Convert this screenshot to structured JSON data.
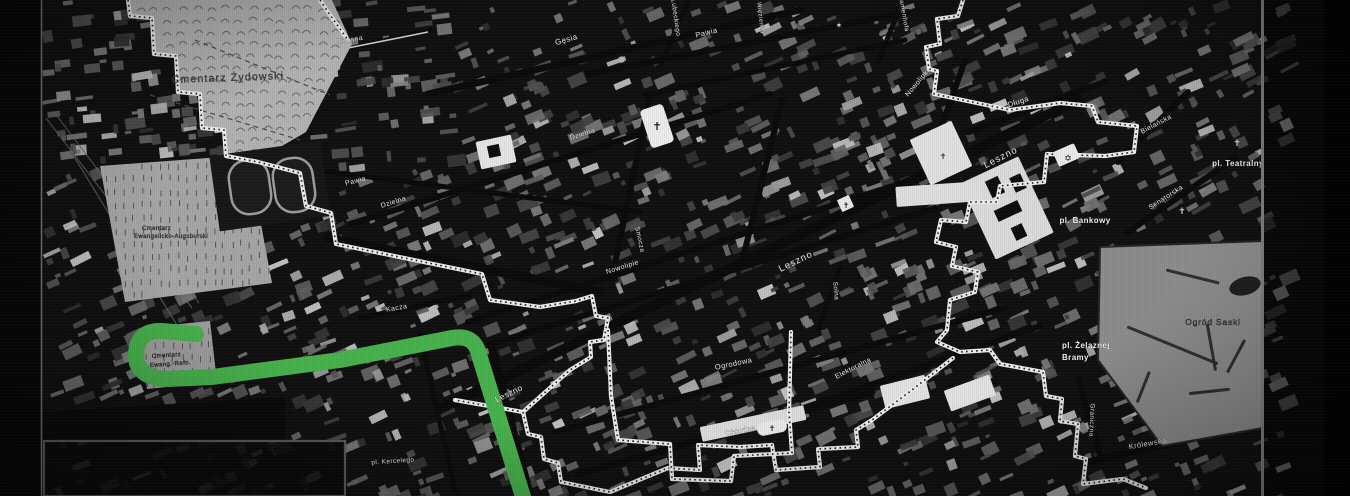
{
  "meta": {
    "width": 1350,
    "height": 496,
    "description": "Stylized dark historical street map of Warsaw with ghetto boundary (white stitched line) and a green walking route"
  },
  "colors": {
    "background": "#101010",
    "street": "#0a0a0a",
    "route_green": "#46b34b",
    "boundary_white": "#ededed",
    "boundary_dot": "#1c1c1c",
    "cemetery_light": "#b3b3b3",
    "park_grey": "#8d8d8d",
    "label_white": "#f2f2f2",
    "label_dark": "#3e3e3e"
  },
  "labels": [
    {
      "text": "Cmentarz Żydowski",
      "x": 228,
      "y": 81,
      "rot": -2,
      "size": 10.5,
      "color": "#4a4a4a",
      "ls": 1.2
    },
    {
      "text": "Cmentarz",
      "x": 142,
      "y": 230,
      "rot": 0,
      "size": 6,
      "color": "#3e3e3e",
      "anchor": "start"
    },
    {
      "text": "Ewangelicko-Augsburski",
      "x": 134,
      "y": 238,
      "rot": 0,
      "size": 6,
      "color": "#3e3e3e",
      "anchor": "start"
    },
    {
      "text": "Cmentarz",
      "x": 152,
      "y": 358,
      "rot": -4,
      "size": 6,
      "color": "#383838",
      "anchor": "start"
    },
    {
      "text": "Ewang.-Refo.",
      "x": 150,
      "y": 367,
      "rot": -4,
      "size": 6,
      "color": "#383838",
      "anchor": "start"
    },
    {
      "text": "Gliniana",
      "x": 349,
      "y": 42,
      "rot": -9,
      "size": 7
    },
    {
      "text": "Gęsia",
      "x": 567,
      "y": 42,
      "rot": -16,
      "size": 8
    },
    {
      "text": "Lubeckiego",
      "x": 674,
      "y": 18,
      "rot": 82,
      "size": 6.5
    },
    {
      "text": "Pawia",
      "x": 707,
      "y": 35,
      "rot": -14,
      "size": 7.5
    },
    {
      "text": "Więzienna",
      "x": 759,
      "y": 18,
      "rot": 84,
      "size": 6
    },
    {
      "text": "Zamenhofa",
      "x": 902,
      "y": 14,
      "rot": 80,
      "size": 6.5
    },
    {
      "text": "Pawia",
      "x": 356,
      "y": 183,
      "rot": -14,
      "size": 7
    },
    {
      "text": "Dzielna",
      "x": 394,
      "y": 204,
      "rot": -17,
      "size": 7
    },
    {
      "text": "Dzielna",
      "x": 583,
      "y": 136,
      "rot": -17,
      "size": 7
    },
    {
      "text": "Smocza",
      "x": 638,
      "y": 240,
      "rot": 78,
      "size": 6.5
    },
    {
      "text": "Nowolipki",
      "x": 919,
      "y": 84,
      "rot": -50,
      "size": 7
    },
    {
      "text": "Nowolipie",
      "x": 623,
      "y": 269,
      "rot": -17,
      "size": 7
    },
    {
      "text": "Leszno",
      "x": 797,
      "y": 264,
      "rot": -26,
      "size": 9.5,
      "ls": 1
    },
    {
      "text": "Leszno",
      "x": 1002,
      "y": 160,
      "rot": -27,
      "size": 9.5,
      "ls": 1
    },
    {
      "text": "Leszno",
      "x": 510,
      "y": 396,
      "rot": -26,
      "size": 8.5
    },
    {
      "text": "Kacza",
      "x": 397,
      "y": 310,
      "rot": -10,
      "size": 7
    },
    {
      "text": "Ogrodowa",
      "x": 734,
      "y": 366,
      "rot": -12,
      "size": 7.5
    },
    {
      "text": "Elektoralna",
      "x": 854,
      "y": 370,
      "rot": -27,
      "size": 7
    },
    {
      "text": "Chłodna",
      "x": 741,
      "y": 433,
      "rot": -11,
      "size": 7.5
    },
    {
      "text": "Solna",
      "x": 834,
      "y": 291,
      "rot": 85,
      "size": 6.5
    },
    {
      "text": "Długa",
      "x": 1019,
      "y": 104,
      "rot": -18,
      "size": 7.5
    },
    {
      "text": "Bielańska",
      "x": 1157,
      "y": 126,
      "rot": -28,
      "size": 7
    },
    {
      "text": "Senatorska",
      "x": 1167,
      "y": 199,
      "rot": -33,
      "size": 7
    },
    {
      "text": "pl. Teatralny",
      "x": 1238,
      "y": 166,
      "rot": 0,
      "size": 8,
      "bold": true
    },
    {
      "text": "pl. Bankowy",
      "x": 1085,
      "y": 223,
      "rot": 0,
      "size": 8,
      "bold": true
    },
    {
      "text": "pl. Żelaznej",
      "x": 1062,
      "y": 348,
      "rot": 0,
      "size": 8,
      "bold": true,
      "anchor": "start"
    },
    {
      "text": "Bramy",
      "x": 1062,
      "y": 360,
      "rot": 0,
      "size": 8,
      "bold": true,
      "anchor": "start"
    },
    {
      "text": "Ogród Saski",
      "x": 1213,
      "y": 325,
      "rot": 0,
      "size": 8.5,
      "color": "#3c3c3c",
      "ls": 0.8
    },
    {
      "text": "Królewska",
      "x": 1148,
      "y": 446,
      "rot": -10,
      "size": 7.5
    },
    {
      "text": "Graniczna",
      "x": 1090,
      "y": 420,
      "rot": 92,
      "size": 6.5
    },
    {
      "text": "pl. Kercelego",
      "x": 393,
      "y": 463,
      "rot": -4,
      "size": 6.5
    }
  ],
  "icons": [
    {
      "name": "church-icon-dzielna",
      "glyph": "✝",
      "x": 657,
      "y": 130,
      "size": 11,
      "fill": "#1d1d1d",
      "bg": {
        "x": 645,
        "y": 106,
        "w": 24,
        "h": 40,
        "rx": 4,
        "rot": -18,
        "fill": "#ededed"
      }
    },
    {
      "name": "church-cross-icon-leszno",
      "glyph": "✝",
      "x": 846,
      "y": 208,
      "size": 8,
      "fill": "#222222",
      "bg": {
        "x": 839,
        "y": 197,
        "w": 13,
        "h": 13,
        "rx": 1,
        "rot": -25,
        "fill": "#e9e9e9"
      }
    },
    {
      "name": "church-cross-icon-west",
      "glyph": "✝",
      "x": 943,
      "y": 159,
      "size": 8,
      "fill": "#2a2a2a"
    },
    {
      "name": "star-of-david-icon",
      "glyph": "✡",
      "x": 1068,
      "y": 161,
      "size": 9,
      "fill": "#1e1e1e",
      "bg": {
        "x": 1055,
        "y": 147,
        "w": 23,
        "h": 16,
        "rx": 2,
        "rot": -24,
        "fill": "#ececec"
      }
    },
    {
      "name": "synagogue-star-icon",
      "glyph": "✶",
      "x": 839,
      "y": 28,
      "size": 8,
      "fill": "#e8e8e8"
    },
    {
      "name": "church-cross-icon-senatorska",
      "glyph": "✝",
      "x": 1182,
      "y": 214,
      "size": 9,
      "fill": "#dedede"
    },
    {
      "name": "church-cross-icon-bielanska",
      "glyph": "✝",
      "x": 1237,
      "y": 146,
      "size": 9,
      "fill": "#dedede"
    },
    {
      "name": "church-icon-chlodna",
      "glyph": "✝",
      "x": 772,
      "y": 431,
      "size": 8,
      "fill": "#1d1d1d",
      "bg": {
        "x": 757,
        "y": 421,
        "w": 30,
        "h": 13,
        "rx": 6,
        "rot": -11,
        "fill": "#e9e9e9"
      }
    }
  ],
  "route": {
    "color": "#46b34b",
    "stroke_width": 16,
    "path": "M196,334 L162,331 C142,330 136,342 136,356 C136,372 150,379 168,379 L212,377 L340,360 L452,338 C470,335 477,343 480,358 L524,500"
  },
  "boundary": {
    "color": "#ededed",
    "dot_color": "#1c1c1c",
    "stroke_width": 4.2,
    "paths": [
      "M128,0 L130,16 L152,18 L154,54 L176,56 L178,92 L200,94 L202,128 L224,130 L226,156 L258,162 L300,173 L306,206 L331,213 L336,244 L482,274 L490,300 L540,307 L576,301 L592,296 L596,316 L608,318 L604,340 L590,342 L591,357 L570,370 L523,412 L455,400",
      "M523,412 L528,434 L541,437 L544,459 L558,463 L561,482 L610,492 L668,468 L700,470 L698,445 L740,447 L772,445 L776,470 L820,467 L818,449 L858,447 L856,430 L872,420 L912,390 L953,358",
      "M320,0 L328,12 L338,26 L348,40",
      "M963,0 L958,16 L937,19 L940,44 L926,47 L929,69 L937,71 L934,94 L1010,110 L1060,103 L1092,106 L1098,122 L1137,126 L1134,152 L1105,156 L1047,154 L1044,182 L1000,186 L997,202 L970,202 L966,222 L941,220 L936,242 L956,247 L952,266 L978,272 L975,292 L950,300 L947,330 L937,342 L960,352 L990,350 L1000,364 L1043,372 L1046,396 L1062,399 L1060,421 L1078,424 L1075,456 L1086,459 L1083,484 L1123,479 L1146,488",
      "M608,330 L611,396 L618,440 L670,444 L672,479 L731,481 L734,456 L792,453 L789,412 L791,332"
    ]
  },
  "streets": [
    [
      438,
      410,
      1078,
      100,
      10
    ],
    [
      555,
      432,
      1005,
      308,
      6
    ],
    [
      578,
      474,
      872,
      392,
      7
    ],
    [
      798,
      410,
      1040,
      326,
      6
    ],
    [
      478,
      348,
      935,
      208,
      6
    ],
    [
      468,
      322,
      918,
      178,
      6
    ],
    [
      350,
      224,
      770,
      94,
      6
    ],
    [
      588,
      74,
      908,
      12,
      6
    ],
    [
      428,
      94,
      800,
      10,
      7
    ],
    [
      328,
      238,
      600,
      292,
      9
    ],
    [
      612,
      278,
      650,
      95,
      6
    ],
    [
      742,
      262,
      782,
      100,
      6
    ],
    [
      662,
      62,
      688,
      2,
      5
    ],
    [
      878,
      62,
      903,
      0,
      5
    ],
    [
      492,
      348,
      530,
      496,
      8
    ],
    [
      818,
      330,
      840,
      268,
      5
    ],
    [
      1078,
      378,
      1102,
      462,
      6
    ],
    [
      968,
      132,
      1105,
      82,
      6
    ],
    [
      1118,
      162,
      1188,
      92,
      6
    ],
    [
      1128,
      232,
      1235,
      158,
      6
    ],
    [
      1088,
      462,
      1240,
      428,
      7
    ],
    [
      930,
      160,
      965,
      60,
      6
    ],
    [
      420,
      335,
      455,
      490,
      5
    ],
    [
      360,
      318,
      470,
      295,
      5
    ],
    [
      305,
      58,
      430,
      30,
      4
    ],
    [
      645,
      95,
      905,
      40,
      5
    ],
    [
      300,
      168,
      640,
      212,
      5
    ]
  ],
  "railways": [
    [
      46,
      118,
      192,
      308
    ],
    [
      54,
      112,
      199,
      303
    ],
    [
      70,
      150,
      180,
      330
    ]
  ],
  "areas": [
    {
      "name": "jewish-cemetery",
      "fill": "#b3b3b3",
      "marks": "arc",
      "points": [
        [
          128,
          0
        ],
        [
          332,
          0
        ],
        [
          352,
          44
        ],
        [
          306,
          132
        ],
        [
          258,
          160
        ],
        [
          226,
          156
        ],
        [
          224,
          130
        ],
        [
          202,
          128
        ],
        [
          200,
          94
        ],
        [
          178,
          92
        ],
        [
          176,
          56
        ],
        [
          154,
          54
        ],
        [
          152,
          18
        ],
        [
          130,
          16
        ]
      ]
    },
    {
      "name": "evangelical-cemetery",
      "fill": "#a6a6a6",
      "marks": "tick",
      "points": [
        [
          100,
          166
        ],
        [
          248,
          155
        ],
        [
          272,
          283
        ],
        [
          125,
          302
        ]
      ]
    },
    {
      "name": "reformed-cemetery",
      "fill": "#9e9e9e",
      "marks": "tick",
      "points": [
        [
          140,
          328
        ],
        [
          210,
          321
        ],
        [
          217,
          382
        ],
        [
          147,
          389
        ]
      ]
    },
    {
      "name": "saski-garden-park",
      "fill": "#8d8d8d",
      "marks": "paths",
      "points": [
        [
          1100,
          247
        ],
        [
          1263,
          241
        ],
        [
          1263,
          428
        ],
        [
          1162,
          446
        ],
        [
          1098,
          360
        ]
      ]
    },
    {
      "name": "dark-yard",
      "fill": "#0a0a0a",
      "marks": "none",
      "points": [
        [
          43,
          412
        ],
        [
          285,
          397
        ],
        [
          285,
          441
        ],
        [
          43,
          441
        ]
      ]
    }
  ],
  "stadium": {
    "backdrop": {
      "x": 214,
      "y": 148,
      "w": 112,
      "h": 76
    },
    "rot": -8,
    "stroke": "#9d9d9d",
    "tracks": [
      {
        "x": 230,
        "y": 160,
        "w": 40,
        "h": 54
      },
      {
        "x": 274,
        "y": 158,
        "w": 40,
        "h": 54
      }
    ]
  },
  "buildings": [
    {
      "name": "courts-building",
      "x": 975,
      "y": 166,
      "w": 64,
      "h": 84,
      "rot": -25,
      "fill": "#dcdcdc",
      "inner": [
        [
          988,
          178,
          14,
          18
        ],
        [
          1012,
          175,
          12,
          16
        ],
        [
          995,
          205,
          26,
          12
        ],
        [
          1013,
          225,
          12,
          14
        ]
      ]
    },
    {
      "name": "white-church-block",
      "x": 918,
      "y": 128,
      "w": 46,
      "h": 50,
      "rot": -25,
      "fill": "#e2e2e2",
      "inner": []
    },
    {
      "name": "prison-block",
      "x": 478,
      "y": 138,
      "w": 36,
      "h": 28,
      "rot": -12,
      "fill": "#e6e6e6",
      "inner": [
        [
          488,
          145,
          12,
          12
        ]
      ]
    },
    {
      "name": "white-strip",
      "x": 896,
      "y": 184,
      "w": 86,
      "h": 20,
      "rot": -4,
      "fill": "#dfdfdf",
      "inner": []
    },
    {
      "name": "market-hall-1",
      "x": 882,
      "y": 380,
      "w": 46,
      "h": 24,
      "rot": -14,
      "fill": "#e3e3e3",
      "inner": []
    },
    {
      "name": "market-hall-2",
      "x": 946,
      "y": 382,
      "w": 48,
      "h": 22,
      "rot": -20,
      "fill": "#e3e3e3",
      "inner": []
    },
    {
      "name": "chlodna-boulevard",
      "x": 700,
      "y": 416,
      "w": 106,
      "h": 15,
      "rot": -12,
      "fill": "#dcdcdc",
      "inner": []
    }
  ],
  "pond": {
    "cx": 1245,
    "cy": 286,
    "rx": 16,
    "ry": 9
  },
  "frame": {
    "left_strip": {
      "x": 0,
      "y": 0,
      "w": 41,
      "h": 496
    },
    "left_line_x": 41.5,
    "right_line_x": 1262.5,
    "right_dim": {
      "x": 1263,
      "y": 0,
      "w": 87,
      "h": 496
    },
    "right_edge": {
      "x": 1324,
      "y": 0,
      "w": 26,
      "h": 496
    },
    "kercelego_square": {
      "x": 44,
      "y": 441,
      "w": 301,
      "h": 55
    }
  },
  "texture": {
    "seed": 1337,
    "count": 1500
  }
}
